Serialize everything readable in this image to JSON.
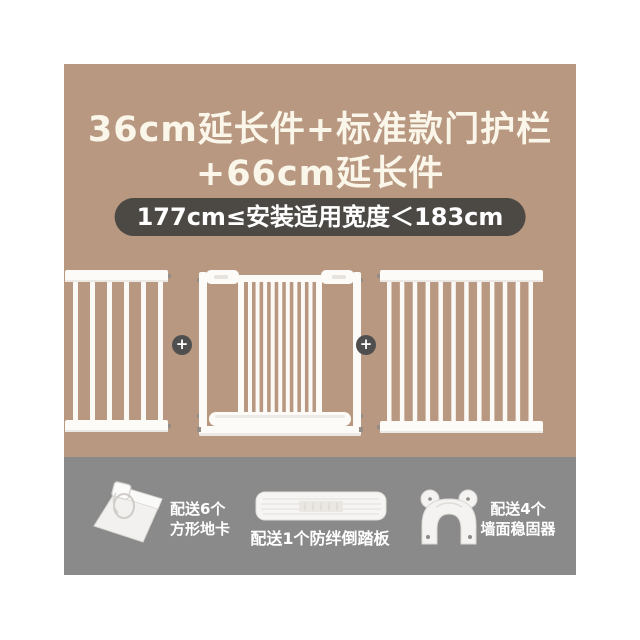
{
  "colors": {
    "canvas_bg": "#ffffff",
    "hero_bg": "#b89881",
    "band_bg": "#8a8a8a",
    "title_text": "#fbf6ea",
    "badge_bg": "#4c4944",
    "badge_text": "#ffffff",
    "plus_bg": "#4f4f4f",
    "gate_white": "#fcfbf8",
    "accessory_text": "#ffffff"
  },
  "title": {
    "line1": "36cm延长件+标准款门护栏",
    "line2": "+66cm延长件"
  },
  "badge": {
    "text": "177cm≤安装适用宽度＜183cm"
  },
  "gates": {
    "left_panel": {
      "name": "36cm-extension-panel",
      "bars": 6
    },
    "middle_gate": {
      "name": "standard-door-gate",
      "bars": 9
    },
    "right_panel": {
      "name": "66cm-extension-panel",
      "bars": 12
    },
    "plus_symbol": "+"
  },
  "accessories": [
    {
      "icon": "square-floor-pad-icon",
      "label_lines": [
        "配送6个",
        "方形地卡"
      ]
    },
    {
      "icon": "anti-trip-pedal-icon",
      "label_lines": [
        "配送1个防绊倒踏板"
      ]
    },
    {
      "icon": "wall-stabilizer-icon",
      "label_lines": [
        "配送4个",
        "墙面稳固器"
      ]
    }
  ]
}
